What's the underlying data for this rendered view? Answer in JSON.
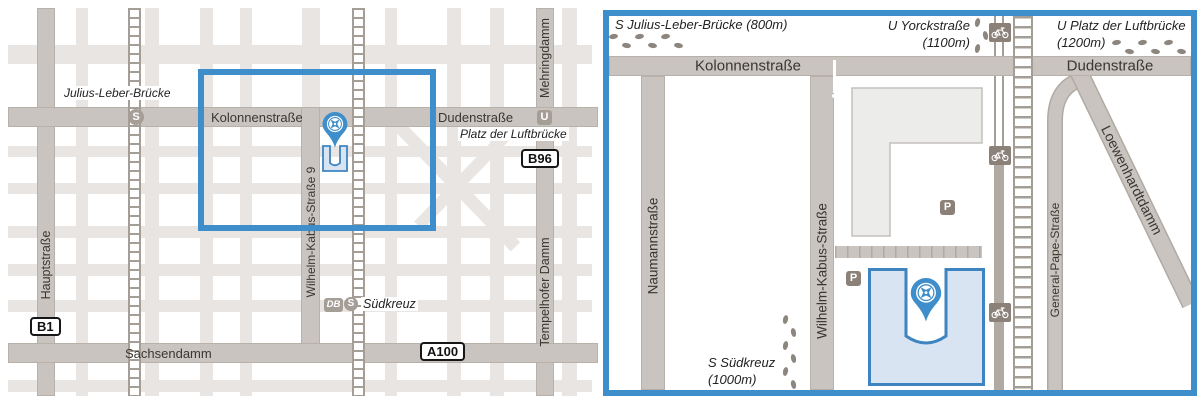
{
  "colors": {
    "accent_blue": "#3e8ecb",
    "road_gray": "#c9c4bf",
    "minor_road_gray": "#e8e5e2",
    "building_gray": "#ececea",
    "highlight_building_fill": "#d9e4f3",
    "badge_gray": "#a59e97",
    "footprint_gray": "#8d867f"
  },
  "left_map": {
    "streets": {
      "kolonnenstrasse": "Kolonnenstraße",
      "dudenstrasse": "Dudenstraße",
      "mehringdamm": "Mehringdamm",
      "wilhelm_kabus_9": "Wilhelm-Kabus-Straße 9",
      "hauptstrasse": "Hauptstraße",
      "sachsendamm": "Sachsendamm",
      "tempelhofer_damm": "Tempelhofer Damm"
    },
    "places": {
      "julius_leber_bruecke": "Julius-Leber-Brücke",
      "platz_der_luftbruecke": "Platz der Luftbrücke",
      "suedkreuz": "Südkreuz"
    },
    "badges": {
      "b1": "B1",
      "b96": "B96",
      "a100": "A100",
      "sbahn": "S",
      "ubahn": "U",
      "db": "DB"
    }
  },
  "right_map": {
    "streets": {
      "kolonnenstrasse": "Kolonnenstraße",
      "dudenstrasse": "Dudenstraße",
      "naumannstrasse": "Naumannstraße",
      "wilhelm_kabus_strasse": "Wilhelm-Kabus-Straße",
      "general_pape_strasse": "General-Pape-Straße",
      "loewenhardtdamm": "Loewenhardtdamm"
    },
    "stations": {
      "julius_leber": "S Julius-Leber-Brücke (800m)",
      "yorckstrasse_line1": "U Yorckstraße",
      "yorckstrasse_line2": "(1100m)",
      "luftbruecke_line1": "U Platz der Luftbrücke",
      "luftbruecke_line2": "(1200m)",
      "suedkreuz_line1": "S Südkreuz",
      "suedkreuz_line2": "(1000m)"
    },
    "parking_label": "P"
  }
}
